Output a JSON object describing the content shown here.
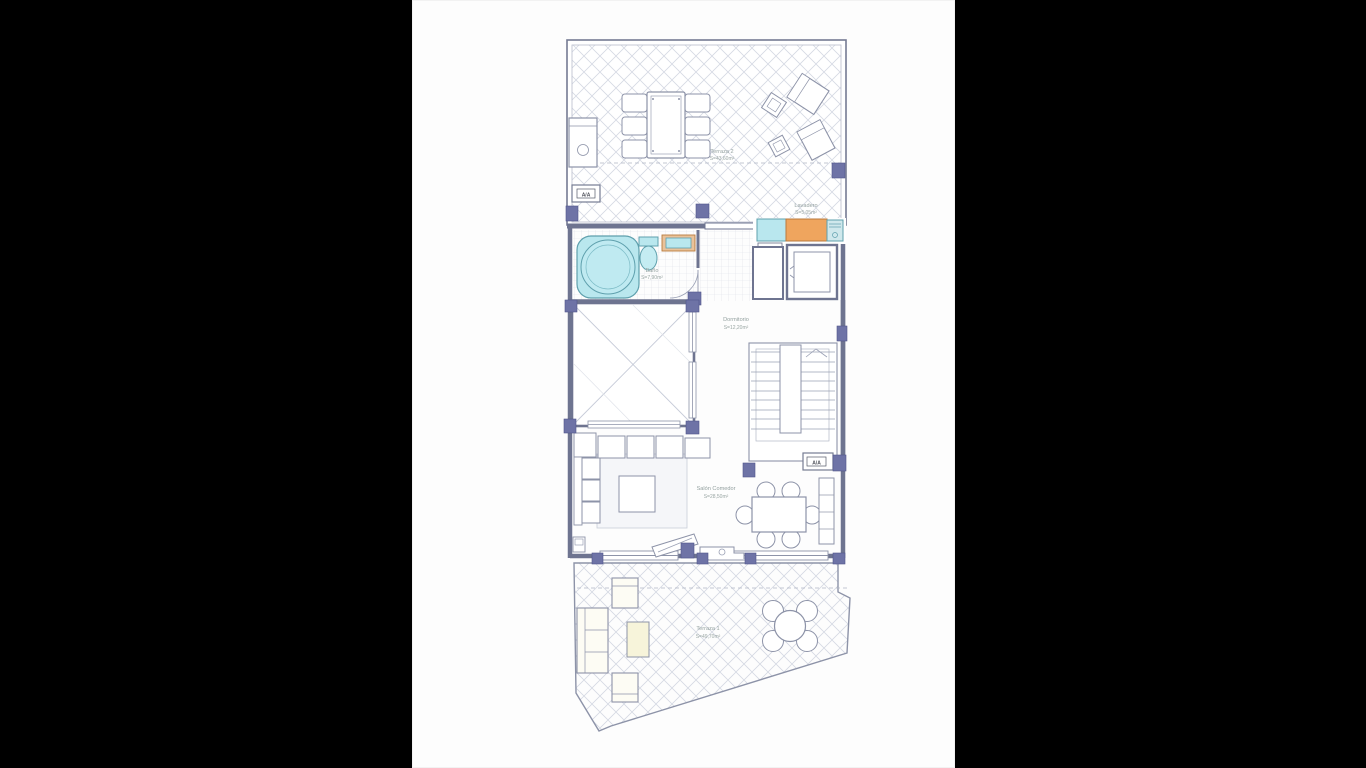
{
  "document": {
    "type": "floor-plan",
    "paper_color": "#fdfdfd",
    "background_color": "#000000"
  },
  "colors": {
    "wall": "#6e7490",
    "thin_line": "#9aa0b4",
    "hatch": "#d5d9e3",
    "tile": "#dde0e8",
    "column": "#6e73a6",
    "water_fixture": "#b9e7ee",
    "water_border": "#5fa0ad",
    "counter": "#efa55e",
    "counter_border": "#b97a3e",
    "rug": "#f5f6f9",
    "table_wood": "#f7f4da",
    "label_text": "#93a09f"
  },
  "rooms": [
    {
      "id": "terraza2",
      "name": "Terraza 2",
      "area": "S=43,60m²"
    },
    {
      "id": "lavadero",
      "name": "Lavadero",
      "area": "S=5,05m²"
    },
    {
      "id": "bano",
      "name": "Baño",
      "area": "S=7,90m²"
    },
    {
      "id": "dormitorio",
      "name": "Dormitorio",
      "area": "S=12,20m²"
    },
    {
      "id": "salon",
      "name": "Salón Comedor",
      "area": "S=28,50m²"
    },
    {
      "id": "terraza1",
      "name": "Terraza 1",
      "area": "S=49,70m²"
    }
  ],
  "labels": {
    "ac_unit": "A/A"
  }
}
